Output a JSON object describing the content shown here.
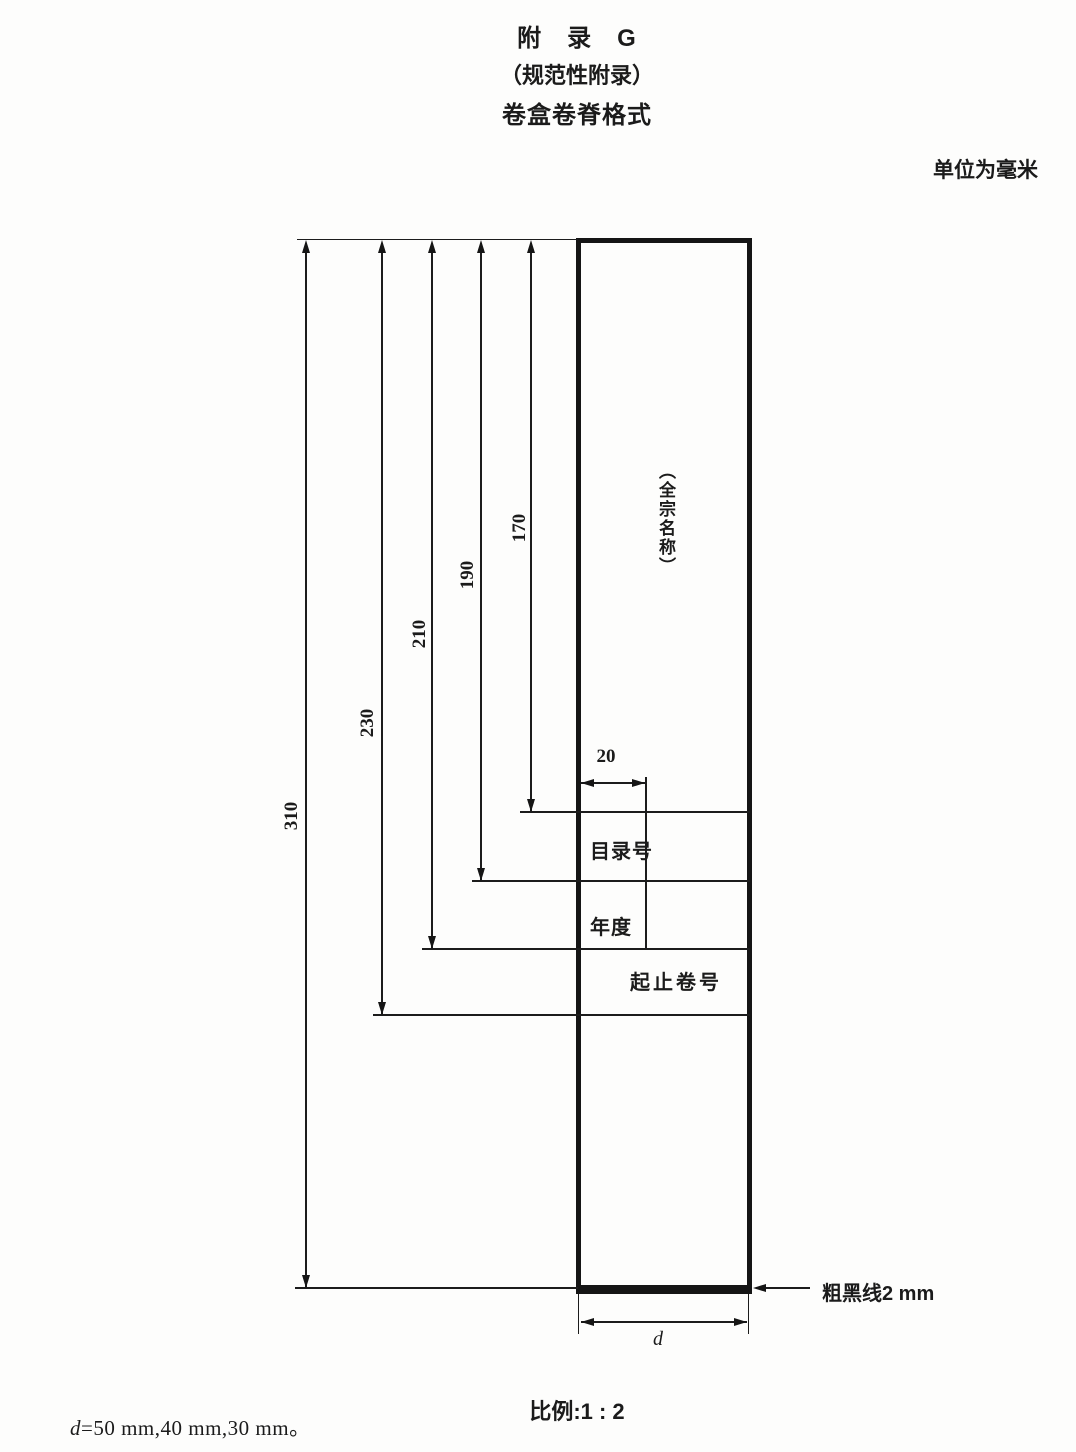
{
  "header": {
    "appendix_title": "附　录　G",
    "appendix_type": "（规范性附录）",
    "appendix_subject": "卷盒卷脊格式",
    "unit_note": "单位为毫米"
  },
  "diagram": {
    "height_dims": [
      {
        "label": "310"
      },
      {
        "label": "230"
      },
      {
        "label": "210"
      },
      {
        "label": "190"
      },
      {
        "label": "170"
      }
    ],
    "column_width_dim": "20",
    "spine_title": "（全宗名称）",
    "row_labels": [
      "目录号",
      "年度",
      "起止卷号"
    ],
    "thick_line_note": "粗黑线2 mm",
    "width_dim_label": "d"
  },
  "footer": {
    "scale_note": "比例:1 : 2",
    "d_variable": "d",
    "d_values": "=50 mm,40 mm,30 mm。"
  }
}
